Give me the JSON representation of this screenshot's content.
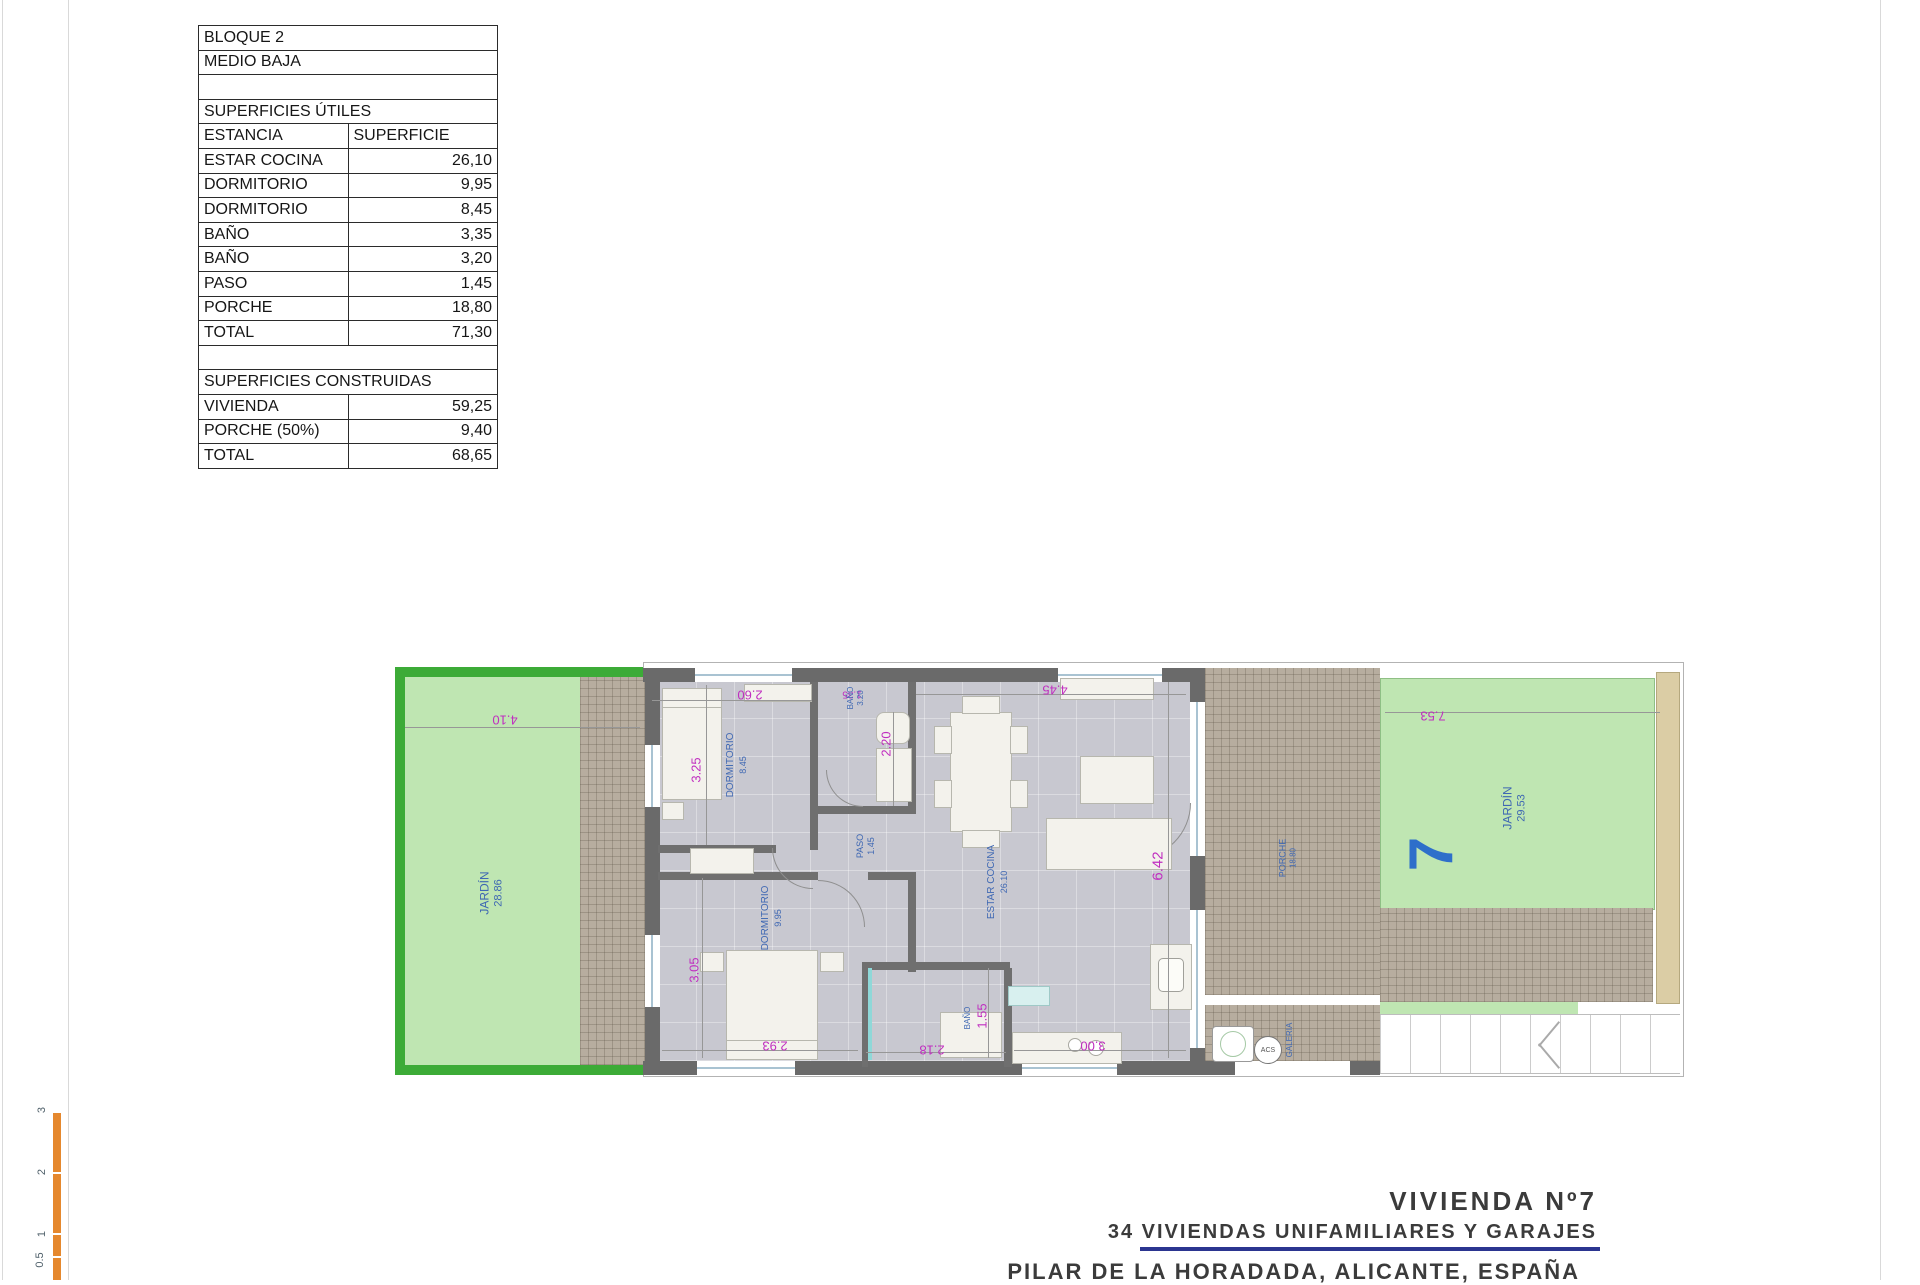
{
  "table": {
    "rows": [
      {
        "label": "BLOQUE 2",
        "value": "",
        "type": "full"
      },
      {
        "label": "MEDIO BAJA",
        "value": "",
        "type": "full"
      },
      {
        "label": "",
        "value": "",
        "type": "full"
      },
      {
        "label": "SUPERFICIES ÚTILES",
        "value": "",
        "type": "full"
      },
      {
        "label": "ESTANCIA",
        "value": "SUPERFICIE",
        "type": "split"
      },
      {
        "label": "ESTAR COCINA",
        "value": "26,10",
        "type": "split"
      },
      {
        "label": "DORMITORIO",
        "value": "9,95",
        "type": "split"
      },
      {
        "label": "DORMITORIO",
        "value": "8,45",
        "type": "split"
      },
      {
        "label": "BAÑO",
        "value": "3,35",
        "type": "split"
      },
      {
        "label": "BAÑO",
        "value": "3,20",
        "type": "split"
      },
      {
        "label": "PASO",
        "value": "1,45",
        "type": "split"
      },
      {
        "label": "PORCHE",
        "value": "18,80",
        "type": "split"
      },
      {
        "label": "TOTAL",
        "value": "71,30",
        "type": "split"
      },
      {
        "label": "",
        "value": "",
        "type": "full"
      },
      {
        "label": "SUPERFICIES CONSTRUIDAS",
        "value": "",
        "type": "full"
      },
      {
        "label": "VIVIENDA",
        "value": "59,25",
        "type": "split"
      },
      {
        "label": "PORCHE (50%)",
        "value": "9,40",
        "type": "split"
      },
      {
        "label": "TOTAL",
        "value": "68,65",
        "type": "split"
      }
    ]
  },
  "plan": {
    "jardin_left": {
      "label": "JARDÍN",
      "area": "28.86"
    },
    "jardin_right": {
      "label": "JARDÍN",
      "area": "29.53",
      "unit": "7"
    },
    "dormitorio1": {
      "label": "DORMITORIO",
      "area": "8.45"
    },
    "dormitorio2": {
      "label": "DORMITORIO",
      "area": "9.95"
    },
    "bano1": {
      "label": "BAÑO",
      "area": "3.20"
    },
    "bano2": {
      "label": "BAÑO"
    },
    "paso": {
      "label": "PASO",
      "area": "1.45"
    },
    "estar": {
      "label": "ESTAR COCINA",
      "area": "26.10"
    },
    "porche": {
      "label": "PORCHE",
      "area": "18.80"
    },
    "galeria": {
      "label": "GALERIA"
    },
    "acs": {
      "label": "ACS"
    },
    "dims": {
      "garden_left_w": "4.10",
      "garden_right_w": "7.53",
      "dorm1_w": "2.60",
      "dorm1_h": "3.25",
      "bano1_w": "1.35",
      "bano1_h": "2.20",
      "estar_w": "4.45",
      "estar_h": "6.42",
      "dorm2_h": "3.05",
      "dorm2_w": "2.93",
      "bano2_w": "2.18",
      "bano2_h": "1.55",
      "cocina_w": "3.00"
    }
  },
  "title_block": {
    "line1": "VIVIENDA Nº7",
    "line2": "34 VIVIENDAS UNIFAMILIARES Y GARAJES",
    "line3": "PILAR DE LA HORADADA, ALICANTE, ESPAÑA"
  },
  "scale_bar": {
    "labels": [
      "3",
      "2",
      "1",
      "0.5"
    ]
  },
  "colors": {
    "garden_border": "#3cab37",
    "garden_fill": "#bfe6b2",
    "wall": "#6a6a6a",
    "dim_text": "#c02ec0",
    "room_label": "#3f68b3",
    "unit_number": "#2e6fca",
    "navy_rule": "#2b3590",
    "scale_bar": "#e5882e",
    "hatch": "#b7ad9f"
  }
}
